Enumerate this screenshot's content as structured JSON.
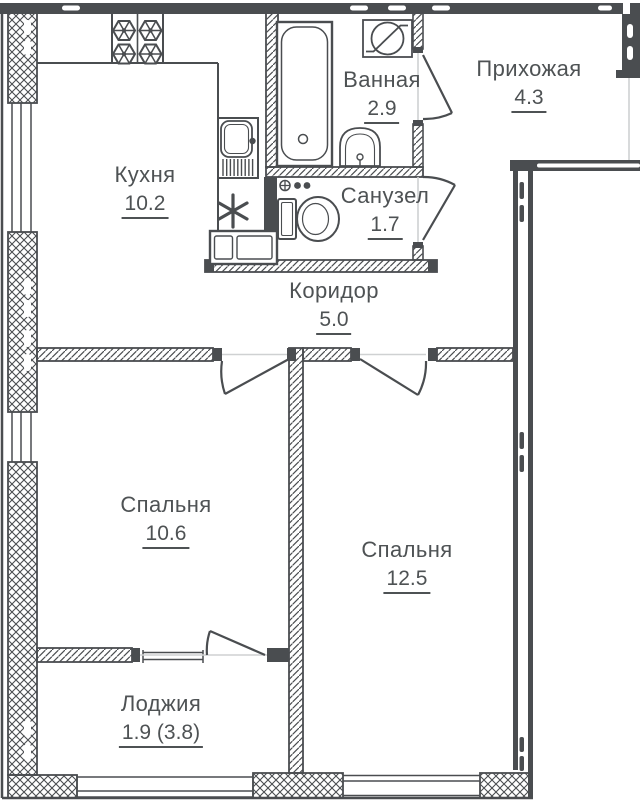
{
  "plan": {
    "background": "#ffffff",
    "wall_color": "#4a4d50",
    "text_color": "#4e5254",
    "rooms": [
      {
        "name": "Кухня",
        "area": "10.2"
      },
      {
        "name": "Ванная",
        "area": "2.9"
      },
      {
        "name": "Прихожая",
        "area": "4.3"
      },
      {
        "name": "Санузел",
        "area": "1.7"
      },
      {
        "name": "Коридор",
        "area": "5.0"
      },
      {
        "name": "Спальня",
        "area": "10.6"
      },
      {
        "name": "Спальня",
        "area": "12.5"
      },
      {
        "name": "Лоджия",
        "area": "1.9 (3.8)"
      }
    ],
    "fixtures": [
      "stove-icon",
      "kitchen-sink-icon",
      "fridge-icon",
      "washing-machine-icon",
      "bathtub-icon",
      "washbasin-icon",
      "electrical-panel-icon",
      "toilet-icon",
      "water-tap-icon"
    ],
    "doors": [
      "bathroom-door",
      "wc-door",
      "bedroom-1-door",
      "bedroom-2-door",
      "balcony-door",
      "entrance-opening"
    ],
    "windows": [
      "kitchen-window",
      "bedroom-1-window",
      "bedroom-2-window",
      "balcony-window",
      "loggia-glazing"
    ]
  }
}
